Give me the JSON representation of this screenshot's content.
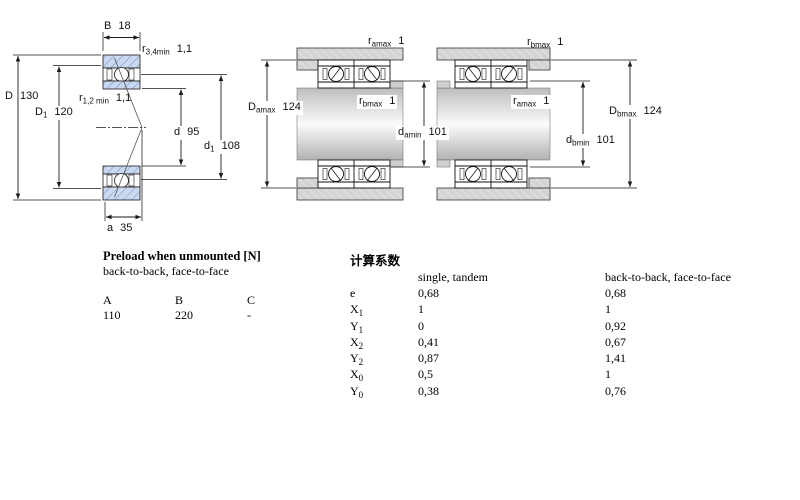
{
  "fig1": {
    "B": {
      "base": "B",
      "sub": "",
      "value": "18"
    },
    "r34": {
      "base": "r",
      "sub": "3,4min",
      "value": "1,1"
    },
    "D": {
      "base": "D",
      "sub": "",
      "value": "130"
    },
    "D1": {
      "base": "D",
      "sub": "1",
      "value": "120"
    },
    "r12": {
      "base": "r",
      "sub": "1,2 min",
      "value": "1,1"
    },
    "d": {
      "base": "d",
      "sub": "",
      "value": "95"
    },
    "d1": {
      "base": "d",
      "sub": "1",
      "value": "108"
    },
    "a": {
      "base": "a",
      "sub": "",
      "value": "35"
    }
  },
  "fig2": {
    "ramax": {
      "base": "r",
      "sub": "amax",
      "value": "1"
    },
    "Damax": {
      "base": "D",
      "sub": "amax",
      "value": "124"
    },
    "rbmax": {
      "base": "r",
      "sub": "bmax",
      "value": "1"
    },
    "damin": {
      "base": "d",
      "sub": "amin",
      "value": "101"
    }
  },
  "fig3": {
    "rbmax": {
      "base": "r",
      "sub": "bmax",
      "value": "1"
    },
    "ramax": {
      "base": "r",
      "sub": "amax",
      "value": "1"
    },
    "dbmin": {
      "base": "d",
      "sub": "bmin",
      "value": "101"
    },
    "Dbmax": {
      "base": "D",
      "sub": "bmax",
      "value": "124"
    }
  },
  "preload": {
    "title": "Preload when unmounted [N]",
    "subtitle": "back-to-back, face-to-face",
    "columns": [
      "A",
      "B",
      "C"
    ],
    "values": [
      "110",
      "220",
      "-"
    ]
  },
  "factors": {
    "title": "计算系数",
    "col1": "single, tandem",
    "col2": "back-to-back, face-to-face",
    "rows": [
      {
        "base": "e",
        "sub": "",
        "v1": "0,68",
        "v2": "0,68"
      },
      {
        "base": "X",
        "sub": "1",
        "v1": "1",
        "v2": "1"
      },
      {
        "base": "Y",
        "sub": "1",
        "v1": "0",
        "v2": "0,92"
      },
      {
        "base": "X",
        "sub": "2",
        "v1": "0,41",
        "v2": "0,67"
      },
      {
        "base": "Y",
        "sub": "2",
        "v1": "0,87",
        "v2": "1,41"
      },
      {
        "base": "X",
        "sub": "0",
        "v1": "0,5",
        "v2": "1"
      },
      {
        "base": "Y",
        "sub": "0",
        "v1": "0,38",
        "v2": "0,76"
      }
    ]
  },
  "colors": {
    "ring_fill": "#cbd9f0",
    "ring_hatch": "#7d97c6",
    "housing_gray": "#d4d4d4",
    "line": "#1a1a1a"
  }
}
